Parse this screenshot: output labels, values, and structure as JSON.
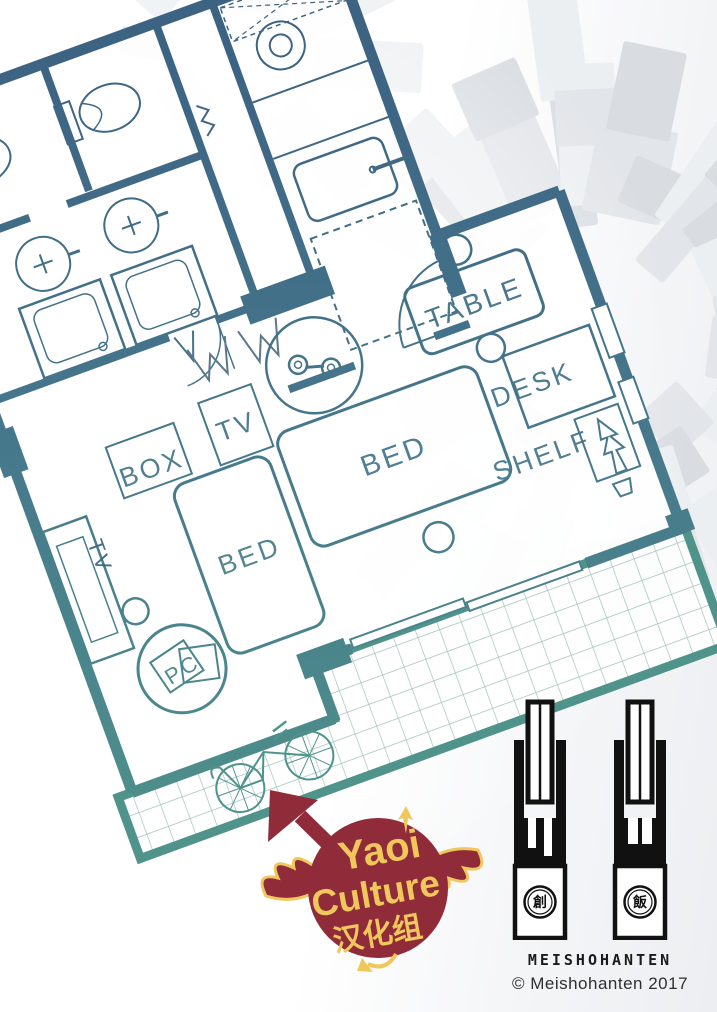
{
  "page": {
    "description": "Floor plan credit page"
  },
  "colors": {
    "wall_blue": "#3d6383",
    "wall_mid": "#46778c",
    "wall_teal": "#4f938b",
    "grid_line": "#a3c2bd",
    "burst_light": "#eceff1",
    "burst_mid": "#e2e5e9",
    "burst_dark": "#d9dde2",
    "logo_maroon": "#902b3a",
    "logo_yellow": "#f0c75c",
    "ink": "#1b1b1b"
  },
  "floor_plan": {
    "labels": {
      "table": "TABLE",
      "box": "BOX",
      "tv": "TV",
      "bed_left": "BED",
      "bed_right": "BED",
      "desk": "DESK",
      "shelf": "SHELF",
      "pc": "PC",
      "tv_stand": "TV"
    }
  },
  "scanlation_logo": {
    "word1": "Yaoi",
    "word2": "Culture",
    "word3": "汉化组"
  },
  "publisher": {
    "wordmark": "MEISHOHANTEN",
    "copyright": "© Meishohanten 2017",
    "seal_left": "創",
    "seal_right": "飯"
  }
}
